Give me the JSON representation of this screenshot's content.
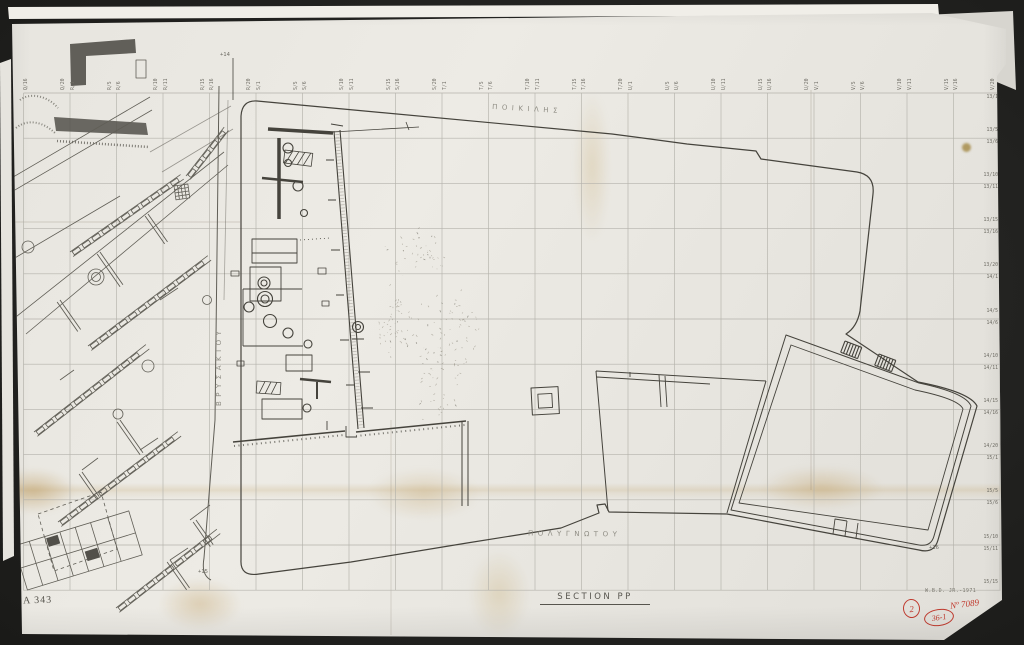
{
  "colors": {
    "background": "#23231f",
    "paper": "#e9e7e1",
    "backing_paper": "#f0eee8",
    "ink": "#45433c",
    "grid_line": "#b4b2ab",
    "label_text": "#6f6d65",
    "greek_text": "#8f8d84",
    "pencil": "#9b968a",
    "red_annotation": "#c03a2e"
  },
  "grid": {
    "column_label_pairs": [
      [
        "",
        "Q/16"
      ],
      [
        "Q/20",
        "R/1"
      ],
      [
        "R/5",
        "R/6"
      ],
      [
        "R/10",
        "R/11"
      ],
      [
        "R/15",
        "R/16"
      ],
      [
        "R/20",
        "S/1"
      ],
      [
        "S/5",
        "S/6"
      ],
      [
        "S/10",
        "S/11"
      ],
      [
        "S/15",
        "S/16"
      ],
      [
        "S/20",
        "T/1"
      ],
      [
        "T/5",
        "T/6"
      ],
      [
        "T/10",
        "T/11"
      ],
      [
        "T/15",
        "T/16"
      ],
      [
        "T/20",
        "U/1"
      ],
      [
        "U/5",
        "U/6"
      ],
      [
        "U/10",
        "U/11"
      ],
      [
        "U/15",
        "U/16"
      ],
      [
        "U/20",
        "V/1"
      ],
      [
        "V/5",
        "V/6"
      ],
      [
        "V/10",
        "V/11"
      ],
      [
        "V/15",
        "V/16"
      ],
      [
        "V/20",
        ""
      ]
    ],
    "row_label_pairs": [
      [
        "",
        "13/1"
      ],
      [
        "13/5",
        "13/6"
      ],
      [
        "13/10",
        "13/11"
      ],
      [
        "13/15",
        "13/16"
      ],
      [
        "13/20",
        "14/1"
      ],
      [
        "14/5",
        "14/6"
      ],
      [
        "14/10",
        "14/11"
      ],
      [
        "14/15",
        "14/16"
      ],
      [
        "14/20",
        "15/1"
      ],
      [
        "15/5",
        "15/6"
      ],
      [
        "15/10",
        "15/11"
      ],
      [
        "15/15",
        ""
      ]
    ]
  },
  "streets": {
    "north": "ΠΟΙΚΙΛΗΣ",
    "west": "ΒΡΥΣΑΚΙΟΥ",
    "south": "ΠΟΛΥΓΝΩΤΟΥ"
  },
  "benchmarks": {
    "top_left": "+14",
    "bottom_left": "+15",
    "bottom_right": "+16"
  },
  "title": "SECTION PP",
  "sheet_number": "A 343",
  "credit": "W.B.D. JR.-1971",
  "red_annotations": {
    "circled_number": "2",
    "circled_code": "36-1",
    "inventory_number": "Nº 7089"
  }
}
